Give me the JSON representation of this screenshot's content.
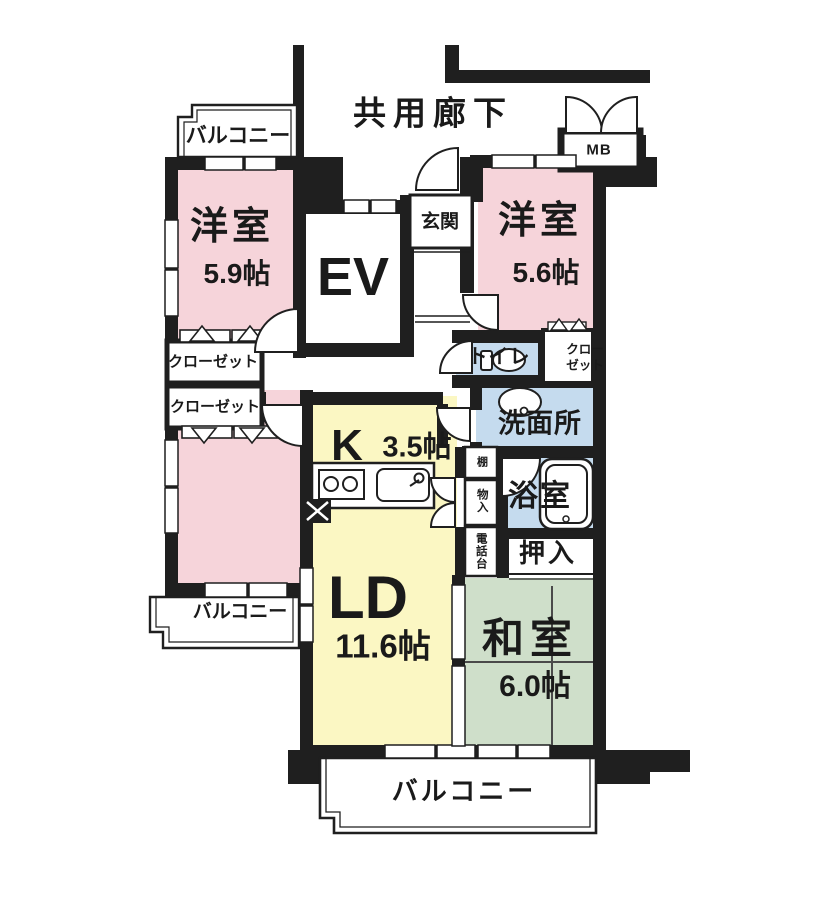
{
  "corridor": {
    "label": "共用廊下"
  },
  "elevator": {
    "label": "EV"
  },
  "entrance": {
    "label": "玄関"
  },
  "meter_box": {
    "label": "MB"
  },
  "balconies": {
    "top_left": "バルコニー",
    "bottom_left": "バルコニー",
    "bottom": "バルコニー"
  },
  "rooms": {
    "bedroom_nw": {
      "name": "洋室",
      "size": "5.9帖"
    },
    "bedroom_ne": {
      "name": "洋室",
      "size": "5.6帖"
    },
    "bedroom_w": {
      "name": "洋室",
      "size": "6.0帖"
    },
    "kitchen": {
      "name": "K",
      "size": "3.5帖"
    },
    "living_dining": {
      "name": "LD",
      "size": "11.6帖"
    },
    "japanese_room": {
      "name": "和室",
      "size": "6.0帖"
    },
    "washroom": {
      "label": "洗面所"
    },
    "bathroom": {
      "label": "浴室"
    },
    "toilet": {
      "label": "トイレ"
    },
    "futon_closet": {
      "label": "押入"
    }
  },
  "storage": {
    "closet_nw": {
      "label": "クローゼット"
    },
    "closet_w": {
      "label": "クローゼット"
    },
    "closet_ne": {
      "line1": "クロー",
      "line2": "ゼット"
    },
    "shelf": {
      "label": "棚"
    },
    "storage_cabinet": {
      "label": "物入"
    },
    "phone_stand": {
      "label": "電話台"
    }
  },
  "colors": {
    "bedroom_pink": "#f6d4da",
    "living_yellow": "#fbf7c3",
    "tatami_green": "#cfdfca",
    "wet_area_blue": "#c5dbee",
    "wall_black": "#1f1f1f"
  }
}
